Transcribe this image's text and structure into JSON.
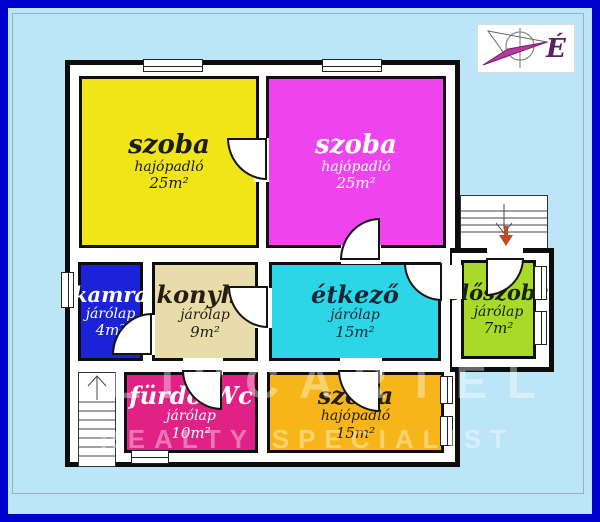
{
  "page": {
    "background_color": "#bce5f8",
    "frame_color": "#0101cd",
    "wall_color": "#0d0d0d"
  },
  "compass": {
    "label": "É",
    "label_color": "#5c2060",
    "needle_color": "#b23a9d"
  },
  "rooms": [
    {
      "id": "szoba-nw",
      "name": "szoba",
      "floor": "hajópadló",
      "area": "25m²",
      "color": "#f0e518",
      "text_color": "#1c1c1c"
    },
    {
      "id": "szoba-ne",
      "name": "szoba",
      "floor": "hajópadló",
      "area": "25m²",
      "color": "#ee44ee",
      "text_color": "#ffffff"
    },
    {
      "id": "kamra",
      "name": "kamra",
      "floor": "járólap",
      "area": "4m²",
      "color": "#1b22d8",
      "text_color": "#ffffff"
    },
    {
      "id": "konyha",
      "name": "konyha",
      "floor": "járólap",
      "area": "9m²",
      "color": "#e9dcab",
      "text_color": "#241d10"
    },
    {
      "id": "etkezo",
      "name": "étkező",
      "floor": "járólap",
      "area": "15m²",
      "color": "#2cd6e6",
      "text_color": "#0e2838"
    },
    {
      "id": "eloszoba",
      "name": "előszoba",
      "floor": "járólap",
      "area": "7m²",
      "color": "#a8da28",
      "text_color": "#16220a"
    },
    {
      "id": "furdo-wc",
      "name": "fürdő-Wc",
      "floor": "járólap",
      "area": "10m²",
      "color": "#e02287",
      "text_color": "#ffffff"
    },
    {
      "id": "szoba-s",
      "name": "szoba",
      "floor": "hajópadló",
      "area": "15m²",
      "color": "#f6b619",
      "text_color": "#241d10"
    }
  ],
  "stairs": {
    "right": {
      "direction": "down",
      "arrow_color": "#c04a28"
    },
    "left": {
      "direction": "up",
      "arrow_color": "#444444"
    }
  },
  "watermark": {
    "line1": "LIVCARTEL",
    "line2": "REALTY SPECIALIST"
  }
}
